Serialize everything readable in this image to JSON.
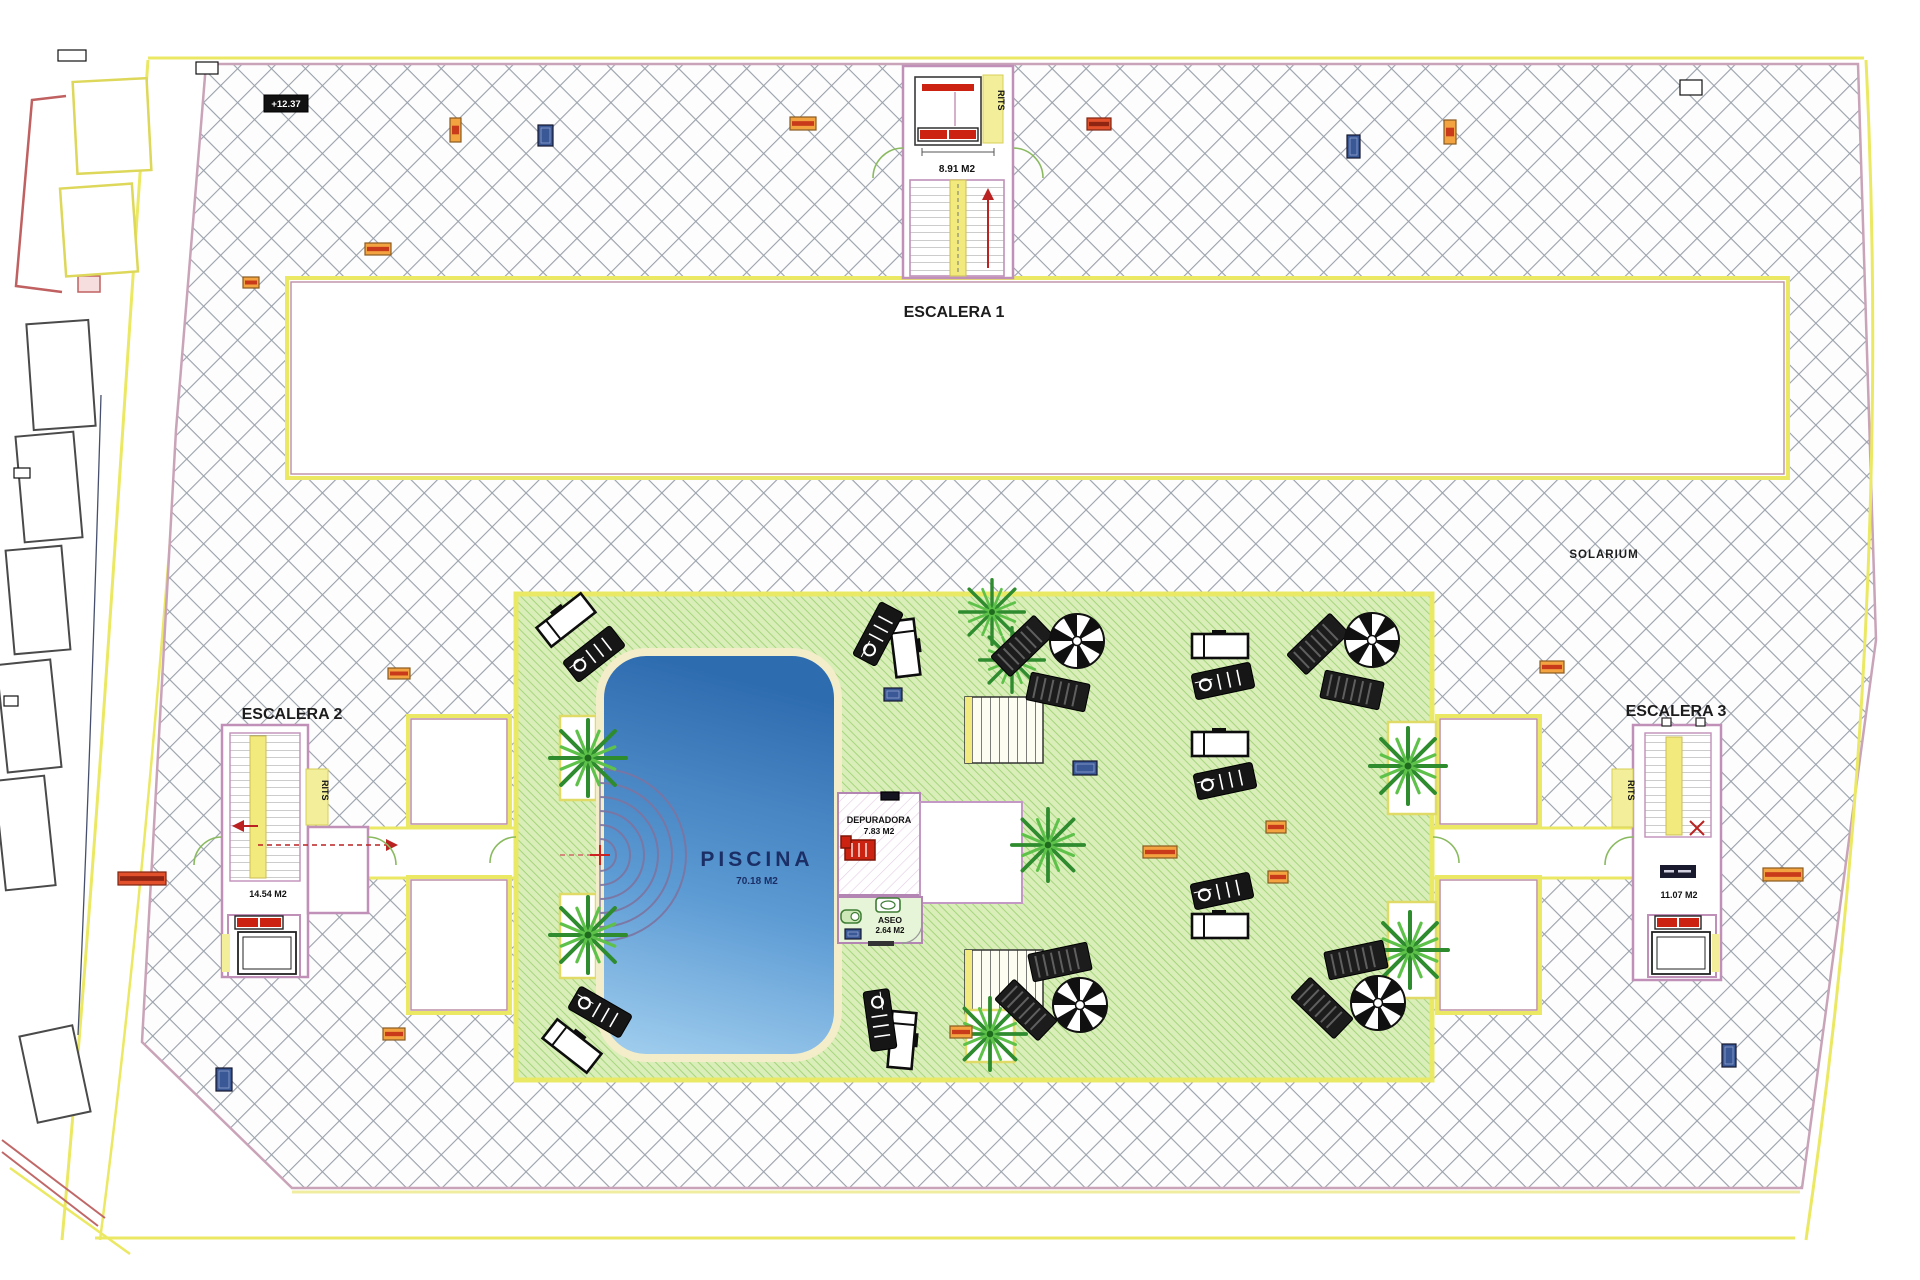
{
  "colors": {
    "hatch_line": "#9aa1ab",
    "boundary_yellow": "#ebe864",
    "wall_pink": "#c9a3b8",
    "green_lawn": "#d9eeb9",
    "green_stripe": "#a6d57d",
    "pool_dark": "#2e6cb0",
    "pool_light": "#a3d0ef",
    "pool_border": "#f3edca",
    "accent_red": "#cc2318",
    "marker_orange": "#f3a440",
    "marker_blue": "#3a5796",
    "stair_yellow": "#f2ea7c",
    "door_green": "#8aba60"
  },
  "labels": {
    "escalera1": "ESCALERA 1",
    "escalera2": "ESCALERA 2",
    "escalera3": "ESCALERA 3",
    "solarium": "SOLARIUM",
    "piscina": "PISCINA",
    "depuradora": "DEPURADORA",
    "aseo": "ASEO",
    "rits": "RITS",
    "level_badge": "+12.37"
  },
  "areas": {
    "piscina": "70.18 M2",
    "depuradora": "7.83 M2",
    "aseo": "2.64 M2",
    "escalera1": "8.91 M2",
    "escalera2": "14.54 M2",
    "escalera3": "11.07 M2"
  },
  "markers": [
    {
      "x": 450,
      "y": 118,
      "w": 11,
      "h": 24,
      "t": "o"
    },
    {
      "x": 538,
      "y": 125,
      "w": 15,
      "h": 21,
      "t": "b"
    },
    {
      "x": 790,
      "y": 117,
      "w": 26,
      "h": 13,
      "t": "o"
    },
    {
      "x": 1087,
      "y": 118,
      "w": 24,
      "h": 12,
      "t": "r"
    },
    {
      "x": 1347,
      "y": 135,
      "w": 13,
      "h": 23,
      "t": "b"
    },
    {
      "x": 1444,
      "y": 120,
      "w": 12,
      "h": 24,
      "t": "o"
    },
    {
      "x": 1680,
      "y": 80,
      "w": 22,
      "h": 15,
      "t": "w"
    },
    {
      "x": 196,
      "y": 62,
      "w": 22,
      "h": 12,
      "t": "w"
    },
    {
      "x": 58,
      "y": 50,
      "w": 28,
      "h": 11,
      "t": "w"
    },
    {
      "x": 365,
      "y": 243,
      "w": 26,
      "h": 12,
      "t": "o"
    },
    {
      "x": 243,
      "y": 277,
      "w": 16,
      "h": 11,
      "t": "o"
    },
    {
      "x": 388,
      "y": 668,
      "w": 22,
      "h": 11,
      "t": "o"
    },
    {
      "x": 118,
      "y": 872,
      "w": 48,
      "h": 13,
      "t": "r"
    },
    {
      "x": 383,
      "y": 1028,
      "w": 22,
      "h": 12,
      "t": "o"
    },
    {
      "x": 216,
      "y": 1068,
      "w": 16,
      "h": 23,
      "t": "b"
    },
    {
      "x": 1540,
      "y": 661,
      "w": 24,
      "h": 12,
      "t": "o"
    },
    {
      "x": 1722,
      "y": 1044,
      "w": 14,
      "h": 23,
      "t": "b"
    },
    {
      "x": 1763,
      "y": 868,
      "w": 40,
      "h": 13,
      "t": "o"
    },
    {
      "x": 1143,
      "y": 846,
      "w": 34,
      "h": 12,
      "t": "o"
    },
    {
      "x": 1266,
      "y": 821,
      "w": 20,
      "h": 12,
      "t": "o"
    },
    {
      "x": 1268,
      "y": 871,
      "w": 20,
      "h": 12,
      "t": "o"
    },
    {
      "x": 1073,
      "y": 761,
      "w": 24,
      "h": 14,
      "t": "b"
    },
    {
      "x": 884,
      "y": 688,
      "w": 18,
      "h": 13,
      "t": "b"
    },
    {
      "x": 950,
      "y": 1026,
      "w": 22,
      "h": 12,
      "t": "o"
    },
    {
      "x": 845,
      "y": 929,
      "w": 16,
      "h": 10,
      "t": "b"
    },
    {
      "x": 881,
      "y": 792,
      "w": 18,
      "h": 8,
      "t": "k"
    },
    {
      "x": 14,
      "y": 468,
      "w": 16,
      "h": 10,
      "t": "w"
    },
    {
      "x": 4,
      "y": 696,
      "w": 14,
      "h": 10,
      "t": "w"
    }
  ],
  "palms": [
    [
      588,
      758,
      1.0
    ],
    [
      588,
      935,
      1.0
    ],
    [
      992,
      612,
      0.85
    ],
    [
      1012,
      660,
      0.85
    ],
    [
      1048,
      845,
      0.95
    ],
    [
      990,
      1034,
      0.95
    ],
    [
      1408,
      766,
      1.0
    ],
    [
      1410,
      950,
      1.0
    ]
  ],
  "planters": [
    [
      560,
      716,
      36,
      84
    ],
    [
      560,
      894,
      36,
      84
    ],
    [
      1388,
      722,
      48,
      92
    ],
    [
      1388,
      902,
      48,
      96
    ],
    [
      966,
      1010,
      48,
      52
    ]
  ],
  "white_loungers": [
    [
      566,
      620,
      -38
    ],
    [
      905,
      648,
      83
    ],
    [
      1220,
      646,
      0
    ],
    [
      1220,
      744,
      0
    ],
    [
      1220,
      926,
      0
    ],
    [
      572,
      1046,
      38
    ],
    [
      902,
      1040,
      95
    ]
  ],
  "black_loungers": [
    [
      594,
      654,
      -38
    ],
    [
      878,
      634,
      -62
    ],
    [
      1223,
      681,
      -12
    ],
    [
      1225,
      781,
      -12
    ],
    [
      1222,
      891,
      -12
    ],
    [
      600,
      1012,
      30
    ],
    [
      880,
      1020,
      82
    ]
  ],
  "umbrellas": [
    [
      1077,
      641
    ],
    [
      1372,
      640
    ],
    [
      1080,
      1005
    ],
    [
      1378,
      1003
    ]
  ],
  "sunbeds": [
    [
      1022,
      646,
      -44
    ],
    [
      1058,
      692,
      12
    ],
    [
      1318,
      644,
      -44
    ],
    [
      1352,
      690,
      12
    ],
    [
      1026,
      1010,
      44
    ],
    [
      1060,
      962,
      -12
    ],
    [
      1322,
      1008,
      44
    ],
    [
      1356,
      960,
      -12
    ]
  ]
}
